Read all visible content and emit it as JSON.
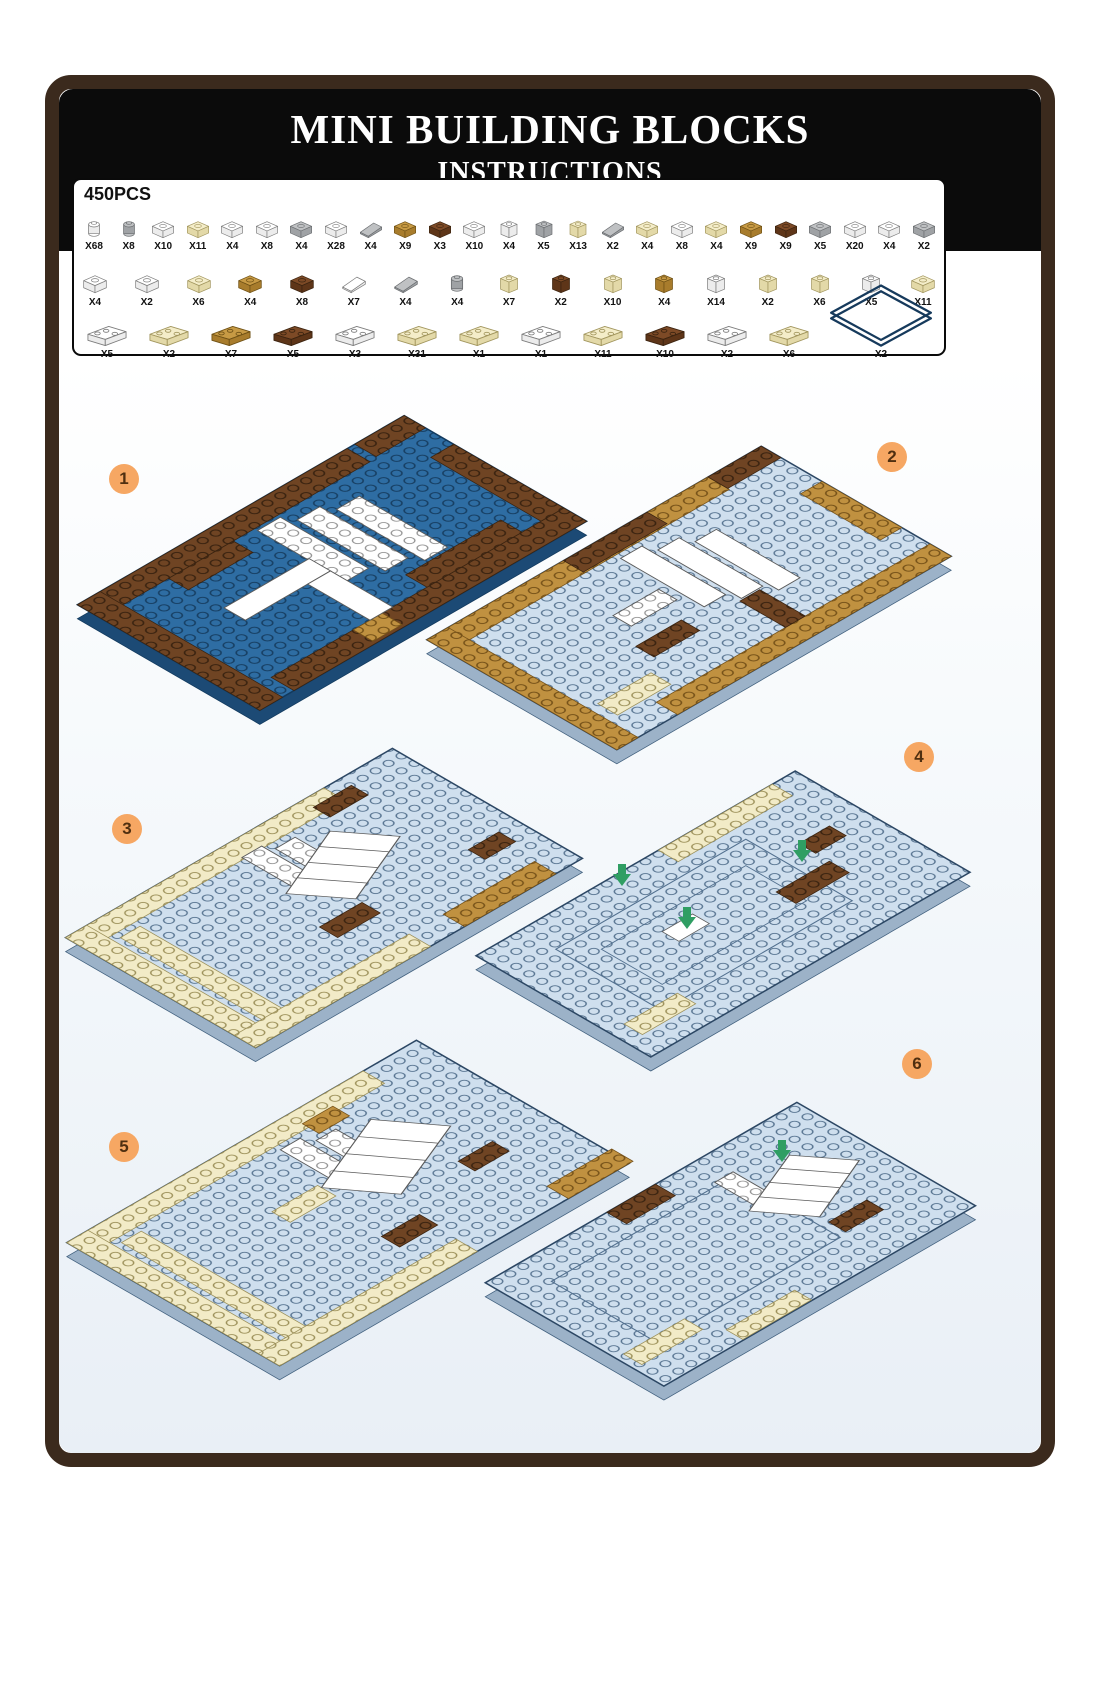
{
  "header": {
    "title": "MINI BUILDING BLOCKS",
    "subtitle": "INSTRUCTIONS",
    "parts_list_label": "PARTS LIST",
    "total_pieces": "450PCS"
  },
  "parts_list": {
    "rows": [
      {
        "items": [
          {
            "qty": "X68",
            "color": "white",
            "shape": "round"
          },
          {
            "qty": "X8",
            "color": "gray",
            "shape": "round"
          },
          {
            "qty": "X10",
            "color": "white",
            "shape": "brick"
          },
          {
            "qty": "X11",
            "color": "cream",
            "shape": "brick"
          },
          {
            "qty": "X4",
            "color": "white",
            "shape": "brick"
          },
          {
            "qty": "X8",
            "color": "white",
            "shape": "brick"
          },
          {
            "qty": "X4",
            "color": "gray",
            "shape": "brick"
          },
          {
            "qty": "X28",
            "color": "white",
            "shape": "brick"
          },
          {
            "qty": "X4",
            "color": "gray",
            "shape": "slope"
          },
          {
            "qty": "X9",
            "color": "tan",
            "shape": "brick"
          },
          {
            "qty": "X3",
            "color": "brown",
            "shape": "brick"
          },
          {
            "qty": "X10",
            "color": "white",
            "shape": "brick"
          },
          {
            "qty": "X4",
            "color": "white",
            "shape": "tall"
          },
          {
            "qty": "X5",
            "color": "gray",
            "shape": "tall"
          },
          {
            "qty": "X13",
            "color": "cream",
            "shape": "tall"
          },
          {
            "qty": "X2",
            "color": "gray",
            "shape": "slope"
          },
          {
            "qty": "X4",
            "color": "cream",
            "shape": "brick"
          },
          {
            "qty": "X8",
            "color": "white",
            "shape": "brick"
          },
          {
            "qty": "X4",
            "color": "cream",
            "shape": "brick"
          },
          {
            "qty": "X9",
            "color": "tan",
            "shape": "brick"
          },
          {
            "qty": "X9",
            "color": "brown",
            "shape": "brick"
          },
          {
            "qty": "X5",
            "color": "gray",
            "shape": "brick"
          },
          {
            "qty": "X20",
            "color": "white",
            "shape": "brick"
          },
          {
            "qty": "X4",
            "color": "white",
            "shape": "brick"
          },
          {
            "qty": "X2",
            "color": "gray",
            "shape": "brick"
          }
        ]
      },
      {
        "items": [
          {
            "qty": "X4",
            "color": "white",
            "shape": "brick"
          },
          {
            "qty": "X2",
            "color": "white",
            "shape": "brick"
          },
          {
            "qty": "X6",
            "color": "cream",
            "shape": "brick"
          },
          {
            "qty": "X4",
            "color": "tan",
            "shape": "brick"
          },
          {
            "qty": "X8",
            "color": "brown",
            "shape": "brick"
          },
          {
            "qty": "X7",
            "color": "white",
            "shape": "slope"
          },
          {
            "qty": "X4",
            "color": "gray",
            "shape": "slope"
          },
          {
            "qty": "X4",
            "color": "gray",
            "shape": "round"
          },
          {
            "qty": "X7",
            "color": "cream",
            "shape": "tall"
          },
          {
            "qty": "X2",
            "color": "brown",
            "shape": "tall"
          },
          {
            "qty": "X10",
            "color": "cream",
            "shape": "tall"
          },
          {
            "qty": "X4",
            "color": "tan",
            "shape": "tall"
          },
          {
            "qty": "X14",
            "color": "white",
            "shape": "tall"
          },
          {
            "qty": "X2",
            "color": "cream",
            "shape": "tall"
          },
          {
            "qty": "X6",
            "color": "cream",
            "shape": "tall"
          },
          {
            "qty": "X5",
            "color": "white",
            "shape": "tall"
          },
          {
            "qty": "X11",
            "color": "cream",
            "shape": "brick"
          }
        ]
      },
      {
        "items": [
          {
            "qty": "X5",
            "color": "white",
            "shape": "long"
          },
          {
            "qty": "X2",
            "color": "cream",
            "shape": "long"
          },
          {
            "qty": "X7",
            "color": "tan",
            "shape": "long"
          },
          {
            "qty": "X5",
            "color": "brown",
            "shape": "long"
          },
          {
            "qty": "X3",
            "color": "white",
            "shape": "long"
          },
          {
            "qty": "X31",
            "color": "cream",
            "shape": "long"
          },
          {
            "qty": "X1",
            "color": "cream",
            "shape": "long"
          },
          {
            "qty": "X1",
            "color": "white",
            "shape": "long"
          },
          {
            "qty": "X11",
            "color": "cream",
            "shape": "long"
          },
          {
            "qty": "X10",
            "color": "brown",
            "shape": "long"
          },
          {
            "qty": "X2",
            "color": "white",
            "shape": "long"
          },
          {
            "qty": "X6",
            "color": "cream",
            "shape": "long"
          },
          {
            "qty": "X2",
            "color": "blue",
            "shape": "baseplate"
          }
        ]
      }
    ]
  },
  "steps": [
    {
      "number": "1"
    },
    {
      "number": "2"
    },
    {
      "number": "3"
    },
    {
      "number": "4"
    },
    {
      "number": "5"
    },
    {
      "number": "6"
    }
  ],
  "theme": {
    "colors": {
      "frame": "#3b2a1d",
      "header_bg": "#0b0b0b",
      "badge": "#f6a763",
      "badge_text": "#4f2f10",
      "panel_top": "#ffffff",
      "panel_bottom": "#e9eff6",
      "base_blue": "#2e6da3",
      "light_blue": "#cfdfee",
      "brown": "#6f4423",
      "tan": "#c09140",
      "cream": "#f2ebc7",
      "arrow_green": "#2f9e63"
    },
    "part_colors": {
      "white": [
        "#ffffff",
        "#ececec",
        "#7d7d7d"
      ],
      "gray": [
        "#bfc1c3",
        "#9fa2a5",
        "#6b6e71"
      ],
      "cream": [
        "#f4edc9",
        "#e3d9a8",
        "#a2965e"
      ],
      "tan": [
        "#c79a44",
        "#a87c2c",
        "#6f5115"
      ],
      "brown": [
        "#7d4a26",
        "#5e3518",
        "#3c2410"
      ],
      "blue": [
        "#2e6da3",
        "#1d4c77",
        "#163a5c"
      ]
    }
  }
}
